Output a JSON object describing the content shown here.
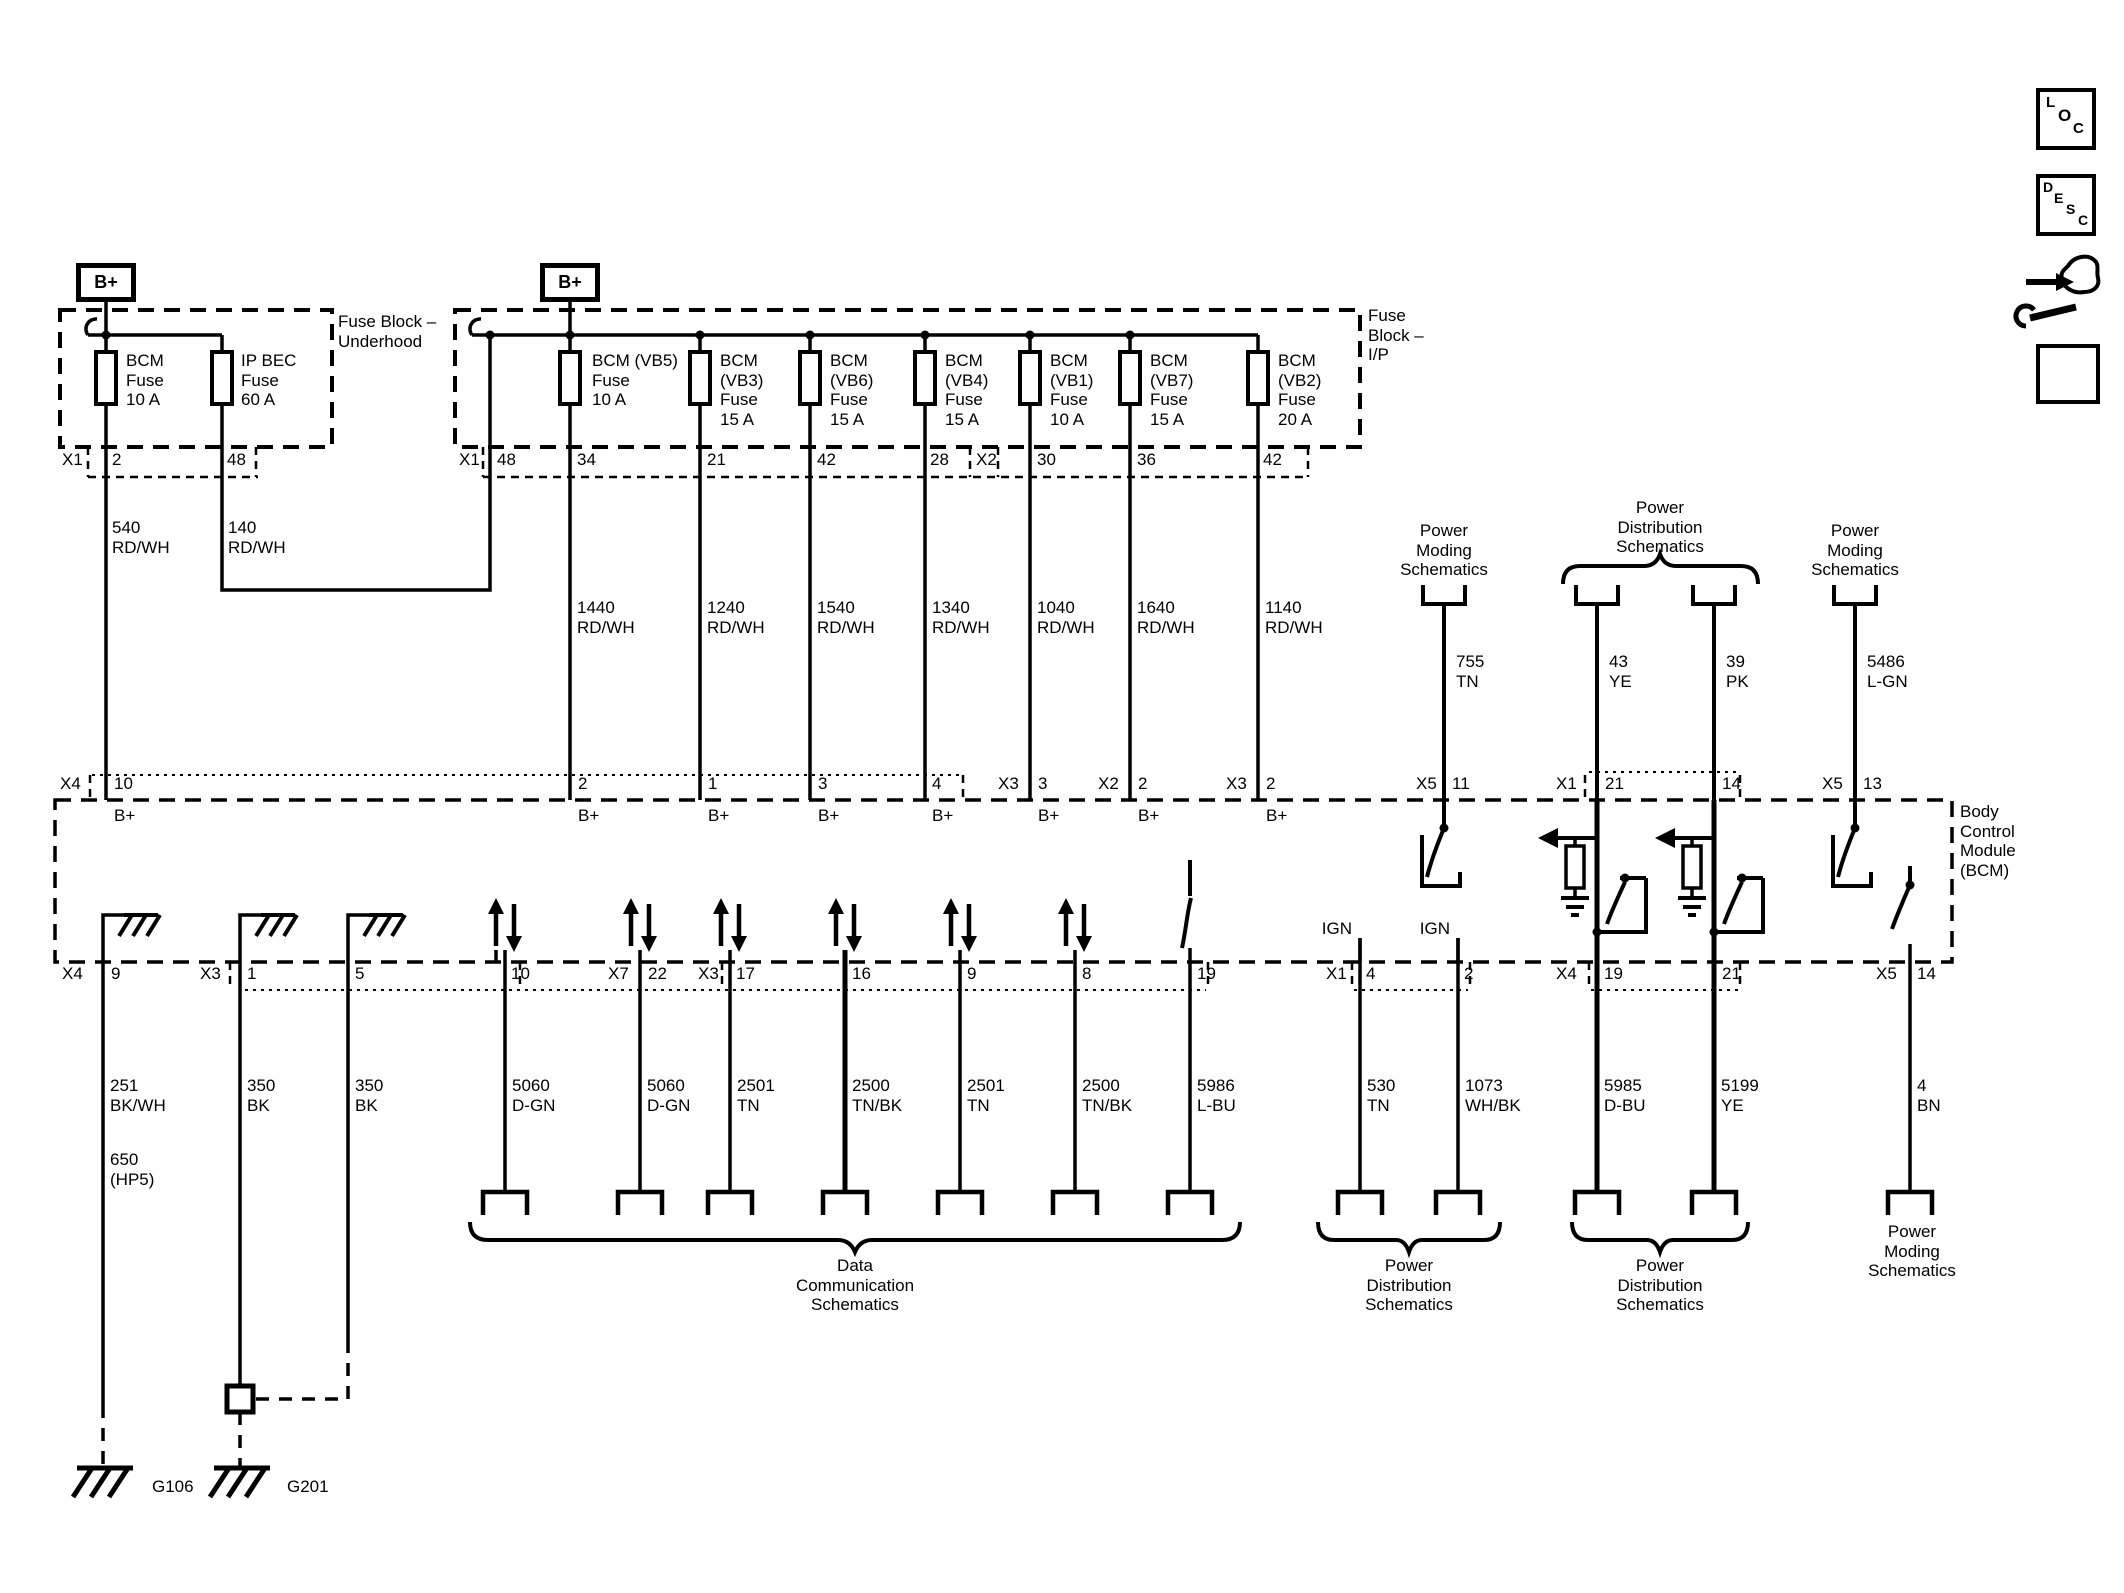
{
  "icons": {
    "loc": [
      "L",
      "O",
      "C"
    ],
    "desc": [
      "D",
      "E",
      "S",
      "C"
    ]
  },
  "underhood": {
    "b_plus": "B+",
    "label": "Fuse Block –\nUnderhood",
    "x1": "X1",
    "pins": [
      "2",
      "48"
    ],
    "fuses": [
      "BCM\nFuse\n10 A",
      "IP BEC\nFuse\n60 A"
    ],
    "wires": [
      "540\nRD/WH",
      "140\nRD/WH"
    ]
  },
  "ip": {
    "b_plus": "B+",
    "label": "Fuse\nBlock –\nI/P",
    "x1": "X1",
    "x2": "X2",
    "pins": [
      "48",
      "34",
      "21",
      "42",
      "28",
      "30",
      "36",
      "42"
    ],
    "fuses": [
      "BCM (VB5)\nFuse\n10 A",
      "BCM\n(VB3)\nFuse\n15 A",
      "BCM\n(VB6)\nFuse\n15 A",
      "BCM\n(VB4)\nFuse\n15 A",
      "BCM\n(VB1)\nFuse\n10 A",
      "BCM\n(VB7)\nFuse\n15 A",
      "BCM\n(VB2)\nFuse\n20 A"
    ],
    "wires": [
      "1440\nRD/WH",
      "1240\nRD/WH",
      "1540\nRD/WH",
      "1340\nRD/WH",
      "1040\nRD/WH",
      "1640\nRD/WH",
      "1140\nRD/WH"
    ]
  },
  "refs_top": {
    "power_moding_left": "Power\nModing\nSchematics",
    "wire_755": "755\nTN",
    "power_distribution": "Power\nDistribution\nSchematics",
    "wire_43": "43\nYE",
    "wire_39": "39\nPK",
    "power_moding_right": "Power\nModing\nSchematics",
    "wire_5486": "5486\nL-GN"
  },
  "bcm": {
    "label": "Body\nControl\nModule\n(BCM)",
    "b_plus": "B+",
    "ign": "IGN",
    "connectors": {
      "x1": "X1",
      "x2": "X2",
      "x3": "X3",
      "x4": "X4",
      "x5": "X5",
      "x7": "X7"
    },
    "top_pins": [
      "10",
      "2",
      "1",
      "3",
      "4",
      "3",
      "2",
      "2",
      "11",
      "21",
      "14",
      "13"
    ],
    "bottom_pins": [
      "9",
      "1",
      "5",
      "10",
      "22",
      "17",
      "16",
      "9",
      "8",
      "19",
      "4",
      "2",
      "19",
      "21",
      "14"
    ]
  },
  "wires_bottom": {
    "list": [
      "251\nBK/WH",
      "350\nBK",
      "350\nBK",
      "5060\nD-GN",
      "5060\nD-GN",
      "2501\nTN",
      "2500\nTN/BK",
      "2501\nTN",
      "2500\nTN/BK",
      "5986\nL-BU",
      "530\nTN",
      "1073\nWH/BK",
      "5985\nD-BU",
      "5199\nYE",
      "4\nBN"
    ],
    "extra_650": "650\n(HP5)"
  },
  "refs_bottom": {
    "data_comm": "Data\nCommunication\nSchematics",
    "power_distribution_1": "Power\nDistribution\nSchematics",
    "power_distribution_2": "Power\nDistribution\nSchematics",
    "power_moding": "Power\nModing\nSchematics",
    "g106": "G106",
    "g201": "G201"
  }
}
